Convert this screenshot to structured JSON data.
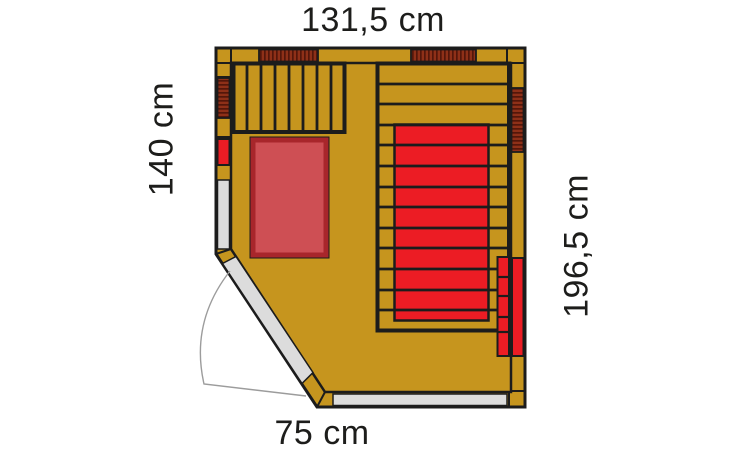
{
  "figure": {
    "type": "floor-plan",
    "subject": "Corner infrared sauna cabin, top view"
  },
  "dimensions": {
    "top": {
      "label": "131,5 cm",
      "side": "top"
    },
    "left": {
      "label": "140 cm",
      "side": "left"
    },
    "right": {
      "label": "196,5 cm",
      "side": "right"
    },
    "bottom": {
      "label": "75 cm",
      "side": "bottom"
    }
  },
  "features": [
    "slatted-bench-left",
    "slatted-bench-right",
    "red-seat-mat",
    "crimson-floor-mat",
    "wall-infrared-emitters",
    "corner-heater-panel",
    "glass-door-with-swing-arc",
    "glass-wall-segments"
  ],
  "colors": {
    "background": "#ffffff",
    "wood": "#c6951e",
    "outline": "#1c1c1c",
    "heater_red": "#ec1c24",
    "mat_fill": "#ce4f54",
    "mat_border": "#a8262b",
    "emitter_dark": "#8e3018",
    "emitter_stripe": "#54170a",
    "glass": "#dcdcdc",
    "arc": "#9c9c9c",
    "label_text": "#1d1d1b"
  }
}
